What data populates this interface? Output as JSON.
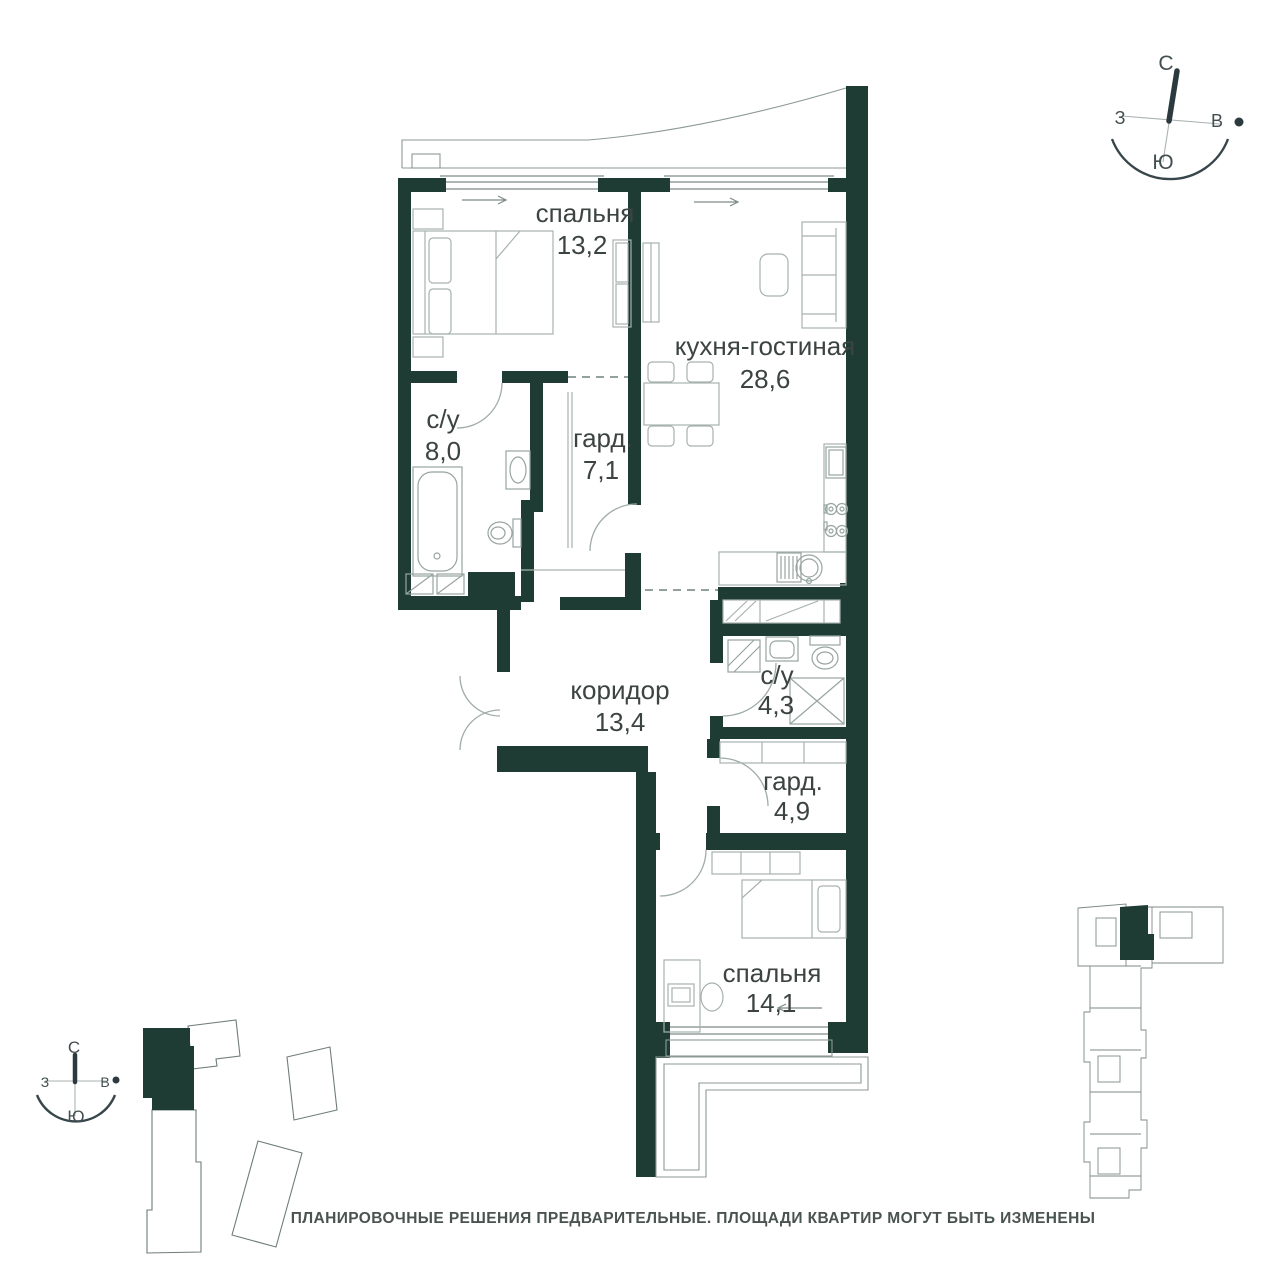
{
  "rooms": [
    {
      "name": "спальня",
      "area": "13,2"
    },
    {
      "name": "кухня-гостиная",
      "area": "28,6"
    },
    {
      "name": "с/у",
      "area": "8,0"
    },
    {
      "name": "гард.",
      "area": "7,1"
    },
    {
      "name": "коридор",
      "area": "13,4"
    },
    {
      "name": "с/у",
      "area": "4,3"
    },
    {
      "name": "гард.",
      "area": "4,9"
    },
    {
      "name": "спальня",
      "area": "14,1"
    }
  ],
  "compass": {
    "north": "С",
    "south": "Ю",
    "west": "З",
    "east": "В"
  },
  "footer": {
    "disclaimer": "ПЛАНИРОВОЧНЫЕ РЕШЕНИЯ ПРЕДВАРИТЕЛЬНЫЕ. ПЛОЩАДИ КВАРТИР МОГУТ БЫТЬ ИЗМЕНЕНЫ"
  },
  "colors": {
    "wall": "#1e3b34",
    "furniture": "#a6b2ae",
    "label": "#3c4441"
  }
}
